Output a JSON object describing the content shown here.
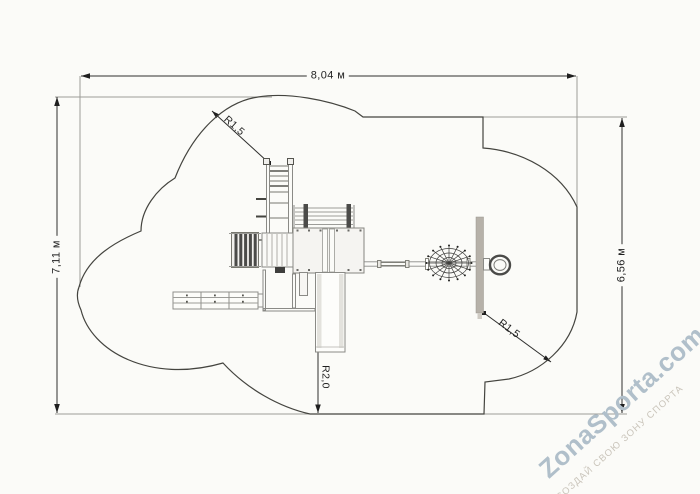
{
  "page": {
    "background": "#fbfbf8",
    "type": "playground layout plan (top view)"
  },
  "dimensions": {
    "width_label": "8,04 м",
    "height_left_label": "7,11 м",
    "height_right_label": "6,56 м",
    "radius_top_label": "R1,5",
    "radius_bottom_label": "R1,5",
    "radius_slide_label": "R2,0"
  },
  "watermark": {
    "title": "ZonaSporta.com",
    "tagline": "СОЗДАЙ СВОЮ ЗОНУ СПОРТА",
    "title_color": "#b0bfca",
    "tagline_color": "#cac5bb"
  },
  "drawing": {
    "dimension_line_color": "#2f2f2e",
    "extension_line_color": "#9c9c98",
    "safety_zone_outline_color": "#44443f",
    "equipment_line_color": "#8a8a86",
    "panel_fill": "#b6b1a9",
    "dark_part_fill": "#4b4b49",
    "items": [
      "climbing-ladder",
      "arched-dark-ladder",
      "footbridge",
      "play-tower-platform",
      "top-railing",
      "side-bench-rails",
      "lower-deck",
      "slide",
      "balance-beam",
      "spider-net-climber",
      "climbing-panel",
      "ring-hoop"
    ]
  }
}
